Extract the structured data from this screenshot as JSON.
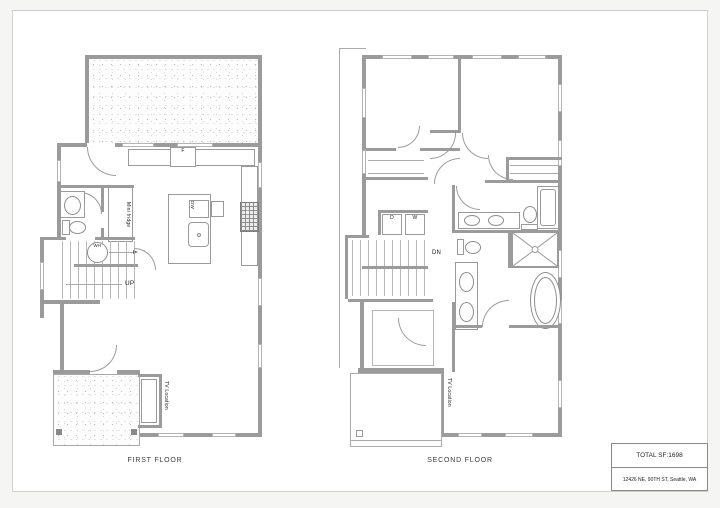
{
  "colors": {
    "wall": "#9b9b9b",
    "line": "#9c9c9c",
    "text": "#1d1d1d",
    "paper": "#ffffff"
  },
  "first_floor": {
    "caption": "FIRST FLOOR",
    "labels": {
      "fridge": "F",
      "mini_fridge": "Mini fridge",
      "dishwasher": "DW",
      "range": "RE",
      "water_heater": "WH",
      "up": "UP",
      "tv_location": "TV Location"
    }
  },
  "second_floor": {
    "caption": "SECOND FLOOR",
    "labels": {
      "dryer": "D",
      "washer": "W",
      "down": "DN",
      "tv_location": "TV Location"
    }
  },
  "title_block": {
    "total_sf": "TOTAL SF:1698",
    "address": "12426 NE, 90TH ST, Seattle, WA"
  }
}
